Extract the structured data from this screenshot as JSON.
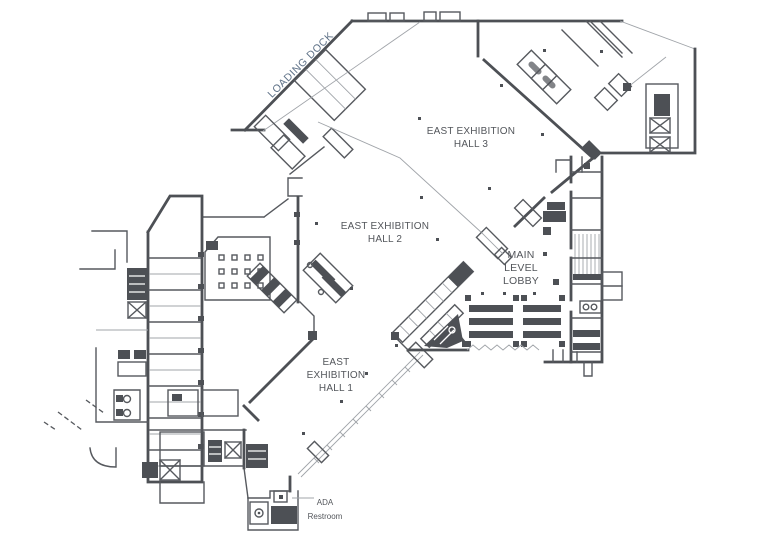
{
  "plan": {
    "colors": {
      "background": "#ffffff",
      "wall": "#4d5055",
      "wall_medium": "#56595e",
      "thin_line": "#a0a4a9",
      "label": "#53565b",
      "loading_dock_label": "#5d7086"
    },
    "rooms": {
      "loading_dock": {
        "label": "LOADING DOCK"
      },
      "east_exhibition_hall_3": {
        "label_line1": "EAST EXHIBITION",
        "label_line2": "HALL 3"
      },
      "east_exhibition_hall_2": {
        "label_line1": "EAST EXHIBITION",
        "label_line2": "HALL 2"
      },
      "main_level_lobby": {
        "label_line1": "MAIN",
        "label_line2": "LEVEL",
        "label_line3": "LOBBY"
      },
      "east_exhibition_hall_1": {
        "label_line1": "EAST",
        "label_line2": "EXHIBITION",
        "label_line3": "HALL 1"
      },
      "ada_restroom": {
        "label_line1": "ADA",
        "label_line2": "Restroom"
      }
    }
  }
}
